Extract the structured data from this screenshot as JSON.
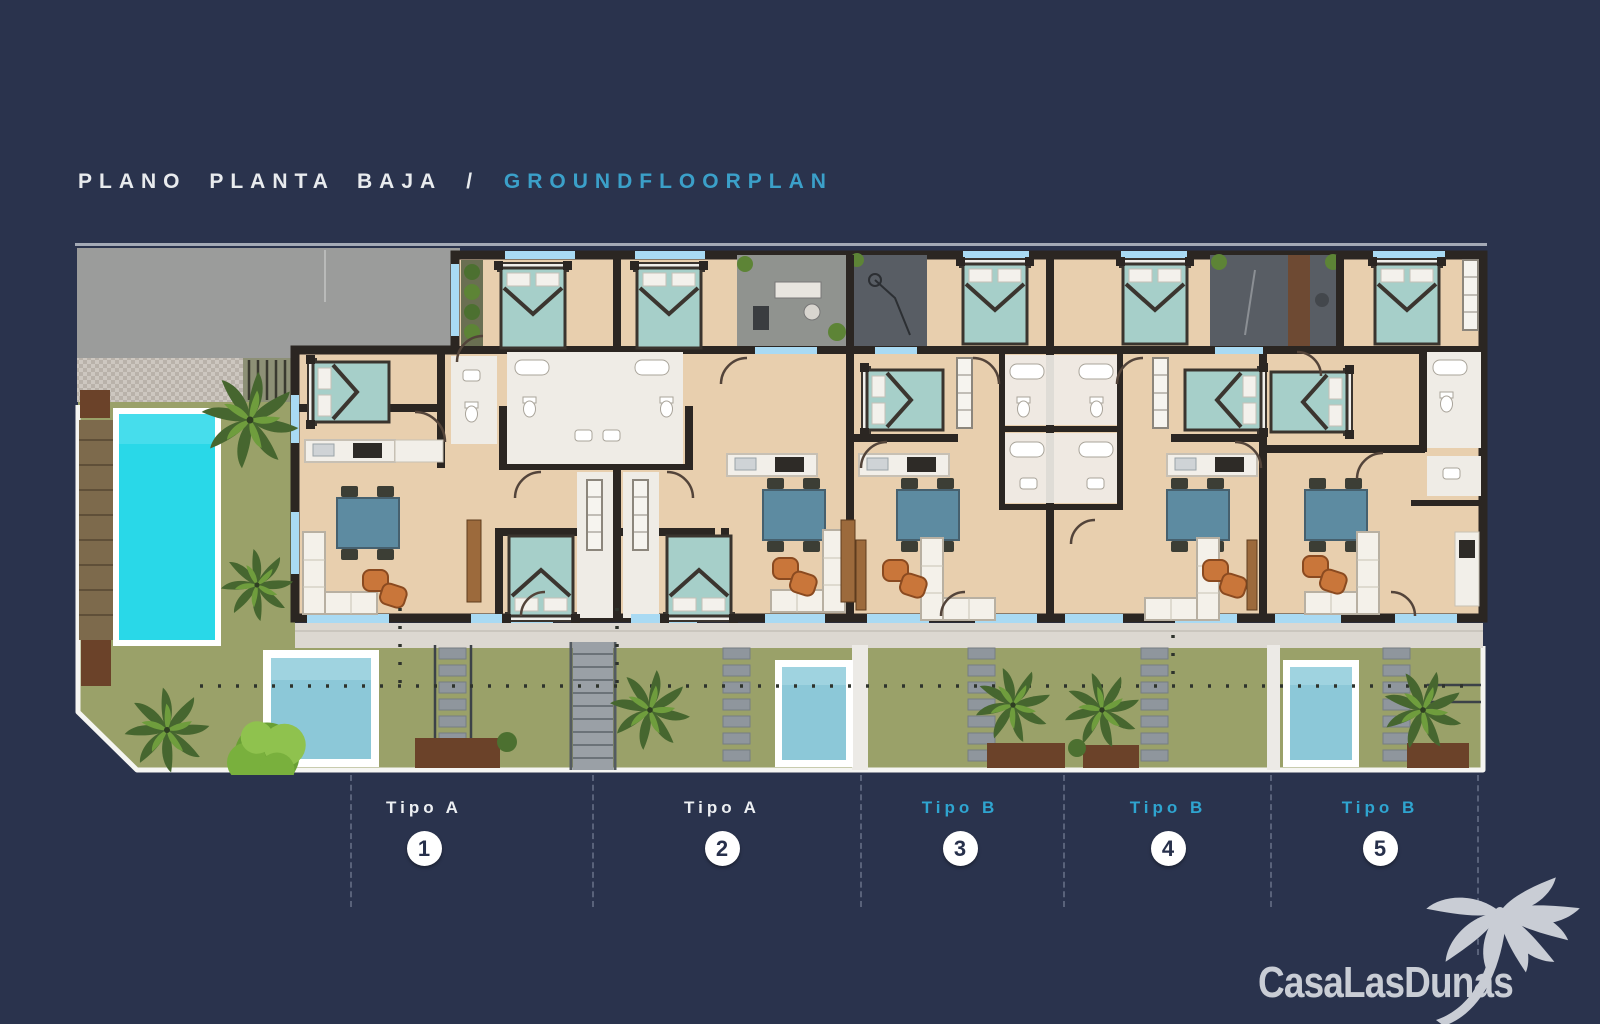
{
  "title": {
    "left": "PLANO PLANTA BAJA",
    "separator": "/",
    "right": "GROUNDFLOORPLAN"
  },
  "units": [
    {
      "label": "Tipo A",
      "number": "1",
      "style": "light"
    },
    {
      "label": "Tipo A",
      "number": "2",
      "style": "light"
    },
    {
      "label": "Tipo B",
      "number": "3",
      "style": "accent"
    },
    {
      "label": "Tipo B",
      "number": "4",
      "style": "accent"
    },
    {
      "label": "Tipo B",
      "number": "5",
      "style": "accent"
    }
  ],
  "logo": {
    "text": "CasaLasDunas",
    "icon": "palm-tree-icon"
  },
  "colors": {
    "background": "#2a334d",
    "title_text": "#e8ebee",
    "title_accent": "#3ba0c9",
    "label_light": "#eceff2",
    "label_accent": "#2fa5d0",
    "circle_bg": "#ffffff",
    "circle_text": "#27304b",
    "divider": "#8089a0",
    "logo": "#c9cdd5",
    "wall": "#2b2622",
    "floor": "#e8cfae",
    "room_white": "#efece6",
    "window": "#a9daf3",
    "bed": "#a6cfc9",
    "table": "#5d8ba1",
    "chair": "#c9763a",
    "lawn": "#9aa169",
    "pool": "#29d8e8",
    "plunge": "#8cc8d8",
    "patio": "#90938f",
    "drive": "#9b9c9b",
    "drive_dark": "#585d64",
    "terrace": "#dcd8d1",
    "path": "#8f969d",
    "mulch": "#6b4229",
    "palm_green": "#46662f",
    "palm_light": "#6f9d3d",
    "bush_green": "#79b03d",
    "wood": "#7d6a4c",
    "white_line": "#f5f5f2"
  }
}
